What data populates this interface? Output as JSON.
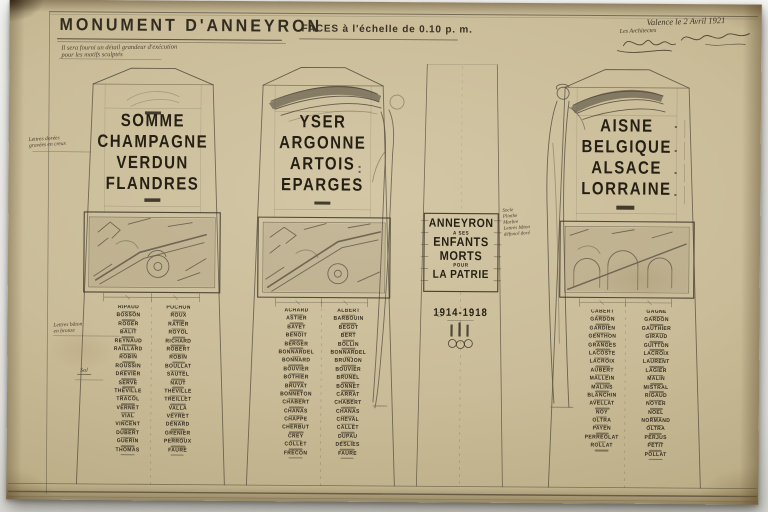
{
  "colors": {
    "paper": "#cabc98",
    "ink": "#29231a",
    "pencil": "#6e6454"
  },
  "header": {
    "title": "MONUMENT D'ANNEYRON",
    "scale_note": "FACES à l'échelle de 0.10 p. m."
  },
  "signature_block": {
    "place_date": "Valence le 2 Avril 1921",
    "role": "Les Architectes"
  },
  "notes": {
    "exec_line1": "Il sera fourni un détail grandeur d'exécution",
    "exec_line2": "pour les motifs sculptés",
    "left_top": [
      "Lettres dorées",
      "gravées en creux"
    ],
    "left_bottom": [
      "Lettres bâton",
      "en bronze"
    ],
    "ground": "Sol",
    "center": [
      "Socle",
      "Plinthe",
      "Marbre",
      "Lettres bâton",
      "défoncé doré"
    ]
  },
  "faces": [
    {
      "id": "left",
      "words": [
        "SOMME",
        "CHAMPAGNE",
        "VERDUN",
        "FLANDRES"
      ],
      "columns": [
        [
          "RIPAUD",
          "BOSSON",
          "ROGER",
          "BALIT",
          "REYNAUD",
          "RAILLARD",
          "ROBIN",
          "ROUSSIN",
          "DREVIER",
          "SERVE",
          "THEVILLE",
          "TRACOL",
          "VERNET",
          "VIAL",
          "VINCENT",
          "DUBERT",
          "GUERIN",
          "THOMAS"
        ],
        [
          "POCHON",
          "ROUX",
          "RATIER",
          "ROYOL",
          "RICHARD",
          "ROBERT",
          "ROBIN",
          "BOULLAT",
          "SAUTEL",
          "NAUT",
          "THEVILLE",
          "TREILLET",
          "VALLA",
          "VEYRET",
          "DENARD",
          "GRENIER",
          "PERROUX",
          "FAURE"
        ]
      ]
    },
    {
      "id": "middle",
      "words": [
        "YSER",
        "ARGONNE",
        "ARTOIS",
        "EPARGES"
      ],
      "columns": [
        [
          "ACHARD",
          "ASTIER",
          "BAYET",
          "BENOIT",
          "BERGER",
          "BONNARDEL",
          "BONNARD",
          "BOUVIER",
          "BOTHIER",
          "BRUYAT",
          "BONNETON",
          "CHABERT",
          "CHANAS",
          "CHAPPE",
          "CHERBUT",
          "CREY",
          "COLLET",
          "FRECON"
        ],
        [
          "ALBERT",
          "BARBOUIN",
          "BEGOT",
          "BERT",
          "BOLLIN",
          "BONNARDEL",
          "BRUNJON",
          "BOUVIER",
          "BRUNEL",
          "BONNET",
          "CARRAT",
          "CHABERT",
          "CHANAS",
          "CHEVAL",
          "CALLET",
          "DUPAU",
          "DESLIES",
          "FAURE"
        ]
      ]
    },
    {
      "id": "right",
      "words": [
        "AISNE",
        "BELGIQUE",
        "ALSACE",
        "LORRAINE"
      ],
      "columns": [
        [
          "CABERT",
          "GARDON",
          "GARDIEN",
          "GENTHON",
          "GRANGES",
          "LACOSTE",
          "LACROIX",
          "AUBERT",
          "MALLEIN",
          "MALINS",
          "BLANCHIN",
          "AVELLAT",
          "NOY",
          "OLTRA",
          "PAYEN",
          "PERREOLAT",
          "ROLLAT"
        ],
        [
          "GAGNE",
          "GARDON",
          "GAUTHIER",
          "GIRAUD",
          "GUITTON",
          "LACROIX",
          "LAURENT",
          "LAGIER",
          "MALIN",
          "MISTRAL",
          "RIGAUD",
          "NOYER",
          "NOEL",
          "NORMAND",
          "OLTRA",
          "PERJUS",
          "PETIT",
          "POLLAT"
        ]
      ]
    }
  ],
  "center_face": {
    "lines": [
      "ANNEYRON",
      "A SES",
      "ENFANTS",
      "MORTS",
      "POUR",
      "LA PATRIE"
    ],
    "years": "1914-1918"
  }
}
